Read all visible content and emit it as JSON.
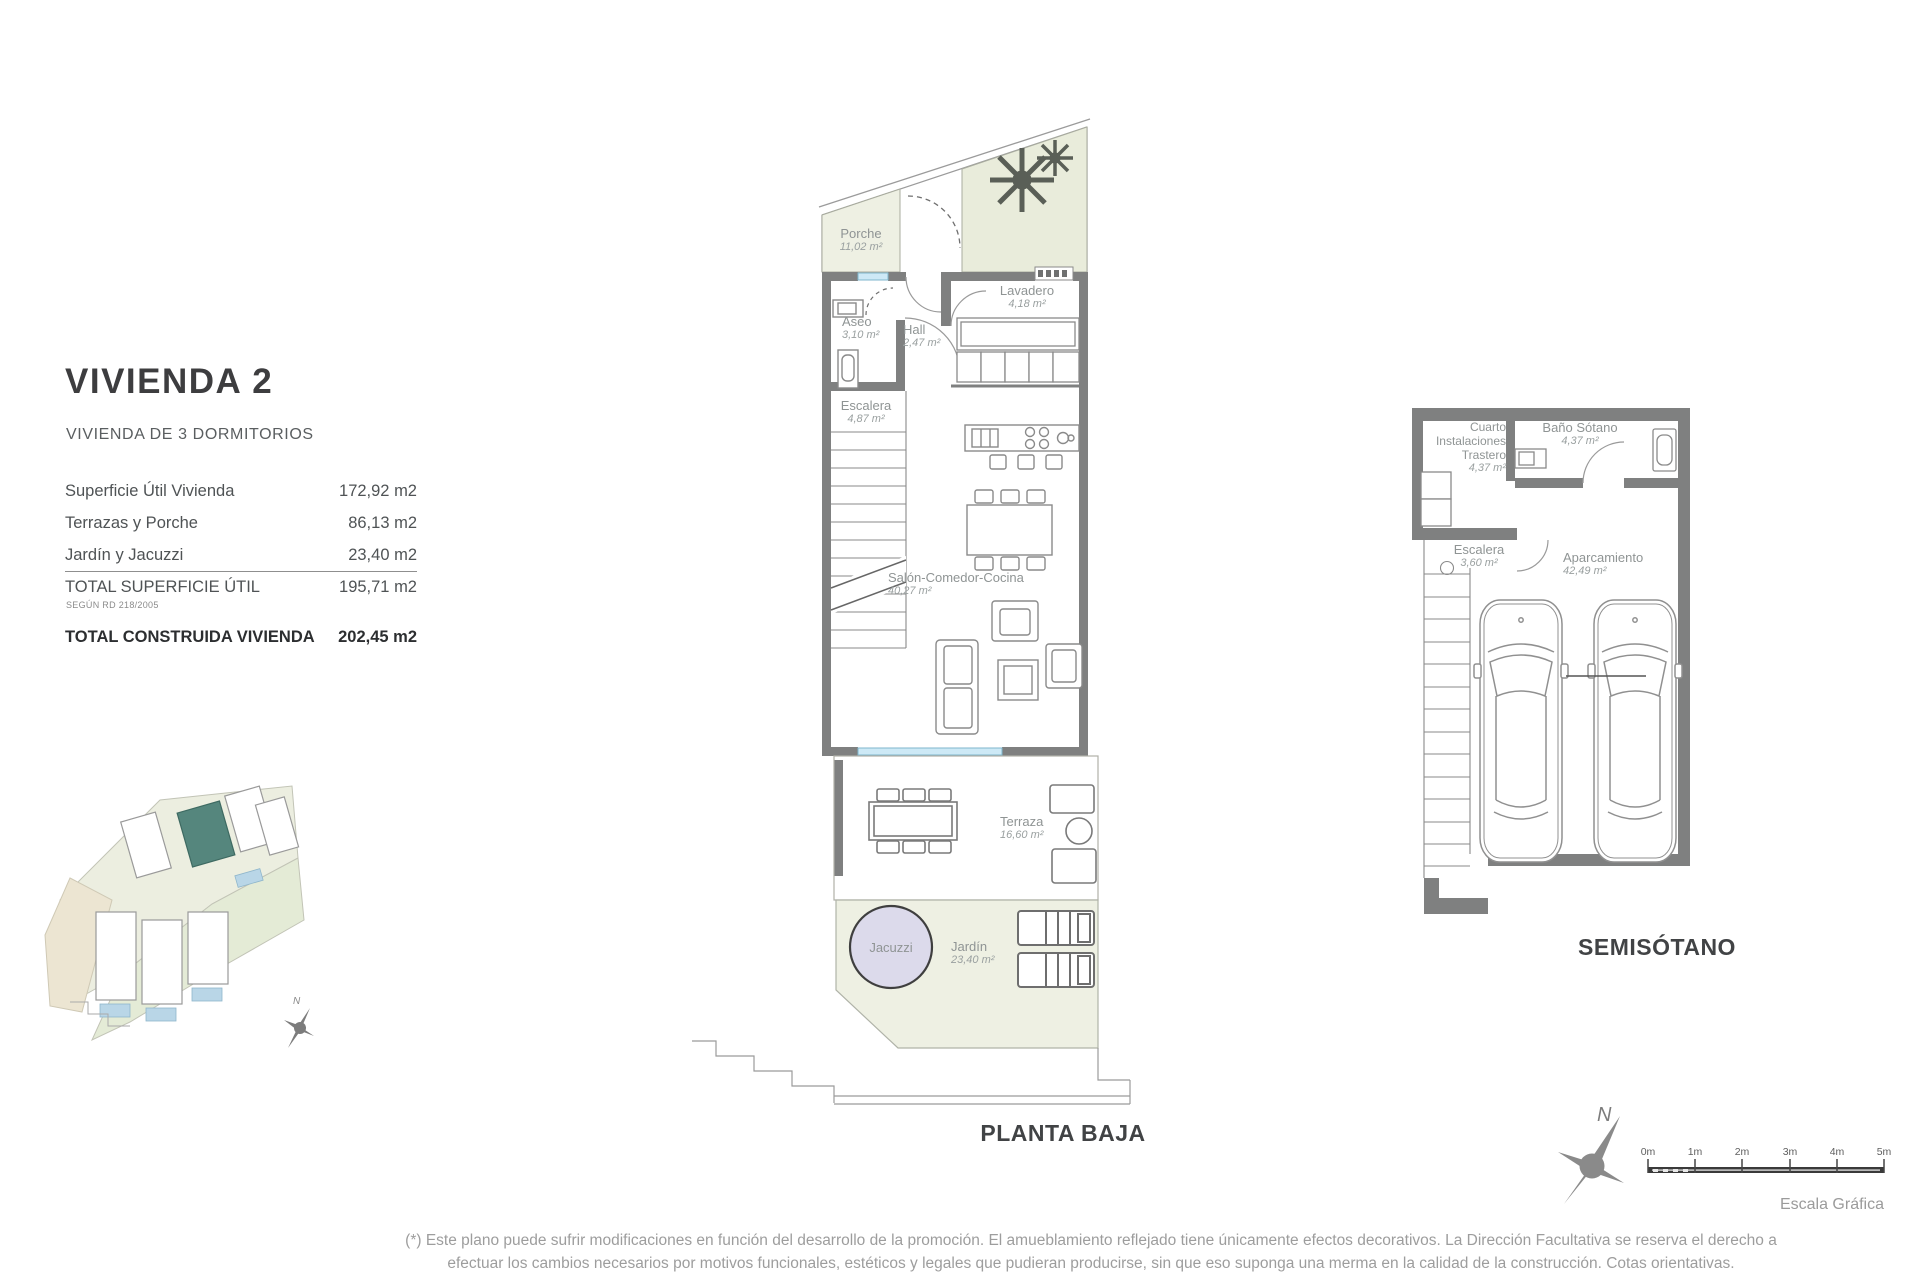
{
  "colors": {
    "wall": "#7f8080",
    "plan_green": "#eef0e3",
    "planting_green": "#e9ecdb",
    "glazing_blue": "#cde9f6",
    "jacuzzi_lavender": "#dcdaeb",
    "highlight_teal": "#55867d"
  },
  "info_panel": {
    "title": "VIVIENDA 2",
    "subtitle": "VIVIENDA DE 3 DORMITORIOS",
    "rows": [
      {
        "label": "Superficie Útil Vivienda",
        "value": "172,92 m2"
      },
      {
        "label": "Terrazas y Porche",
        "value": "86,13 m2"
      },
      {
        "label": "Jardín y Jacuzzi",
        "value": "23,40 m2"
      },
      {
        "label": "TOTAL SUPERFICIE ÚTIL",
        "note": "SEGÚN RD 218/2005",
        "value": "195,71 m2"
      },
      {
        "label": "TOTAL CONSTRUIDA VIVIENDA",
        "value": "202,45 m2"
      }
    ]
  },
  "planta_baja": {
    "title": "PLANTA BAJA",
    "rooms": [
      {
        "name": "Porche",
        "area": "11,02 m²"
      },
      {
        "name": "Aseo",
        "area": "3,10 m²"
      },
      {
        "name": "Hall",
        "area": "2,47 m²"
      },
      {
        "name": "Lavadero",
        "area": "4,18 m²"
      },
      {
        "name": "Escalera",
        "area": "4,87 m²"
      },
      {
        "name": "Salón-Comedor-Cocina",
        "area": "40,27 m²"
      },
      {
        "name": "Terraza",
        "area": "16,60 m²"
      },
      {
        "name": "Jacuzzi",
        "area": ""
      },
      {
        "name": "Jardín",
        "area": "23,40 m²"
      }
    ]
  },
  "semisotano": {
    "title": "SEMISÓTANO",
    "rooms": [
      {
        "name": "Cuarto Instalaciones Trastero",
        "area": "4,37 m²"
      },
      {
        "name": "Baño Sótano",
        "area": "4,37 m²"
      },
      {
        "name": "Escalera",
        "area": "3,60 m²"
      },
      {
        "name": "Aparcamiento",
        "area": "42,49 m²"
      }
    ]
  },
  "compass": {
    "north_label": "N"
  },
  "site_plan": {
    "mini_north_label": "N"
  },
  "scale_bar": {
    "ticks": [
      "0m",
      "1m",
      "2m",
      "3m",
      "4m",
      "5m"
    ],
    "caption": "Escala Gráfica"
  },
  "disclaimer": {
    "line1": "(*) Este plano puede sufrir modificaciones en función del desarrollo de la promoción. El amueblamiento reflejado tiene únicamente efectos decorativos. La Dirección Facultativa se reserva el derecho a",
    "line2": "efectuar los cambios necesarios por motivos funcionales, estéticos y legales que pudieran producirse, sin que eso suponga una merma en la calidad de la construcción. Cotas orientativas."
  }
}
